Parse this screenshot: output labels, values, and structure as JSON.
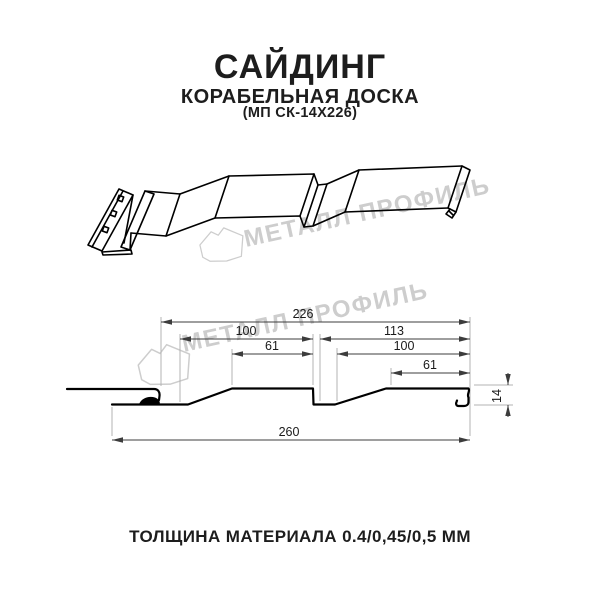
{
  "header": {
    "title": "САЙДИНГ",
    "subtitle": "КОРАБЕЛЬНАЯ ДОСКА",
    "product_code": "(МП СК-14Х226)"
  },
  "watermark": {
    "brand_text": "МЕТАЛЛ ПРОФИЛЬ",
    "color": "#cdcdcd"
  },
  "cross_section": {
    "dim_overall_top": "226",
    "dim_pitch_left": "100",
    "dim_flat_left": "61",
    "dim_right_span": "113",
    "dim_pitch_right": "100",
    "dim_flat_right": "61",
    "dim_height": "14",
    "dim_overall_bottom": "260"
  },
  "footer": {
    "thickness_label": "ТОЛЩИНА МАТЕРИАЛА 0.4/0,45/0,5 ММ"
  },
  "colors": {
    "background": "#ffffff",
    "text": "#1d1d1d",
    "profile_line": "#000000",
    "dimension_line": "#3c3c3c",
    "extension_line": "#b3b3b3",
    "watermark": "#cdcdcd"
  }
}
